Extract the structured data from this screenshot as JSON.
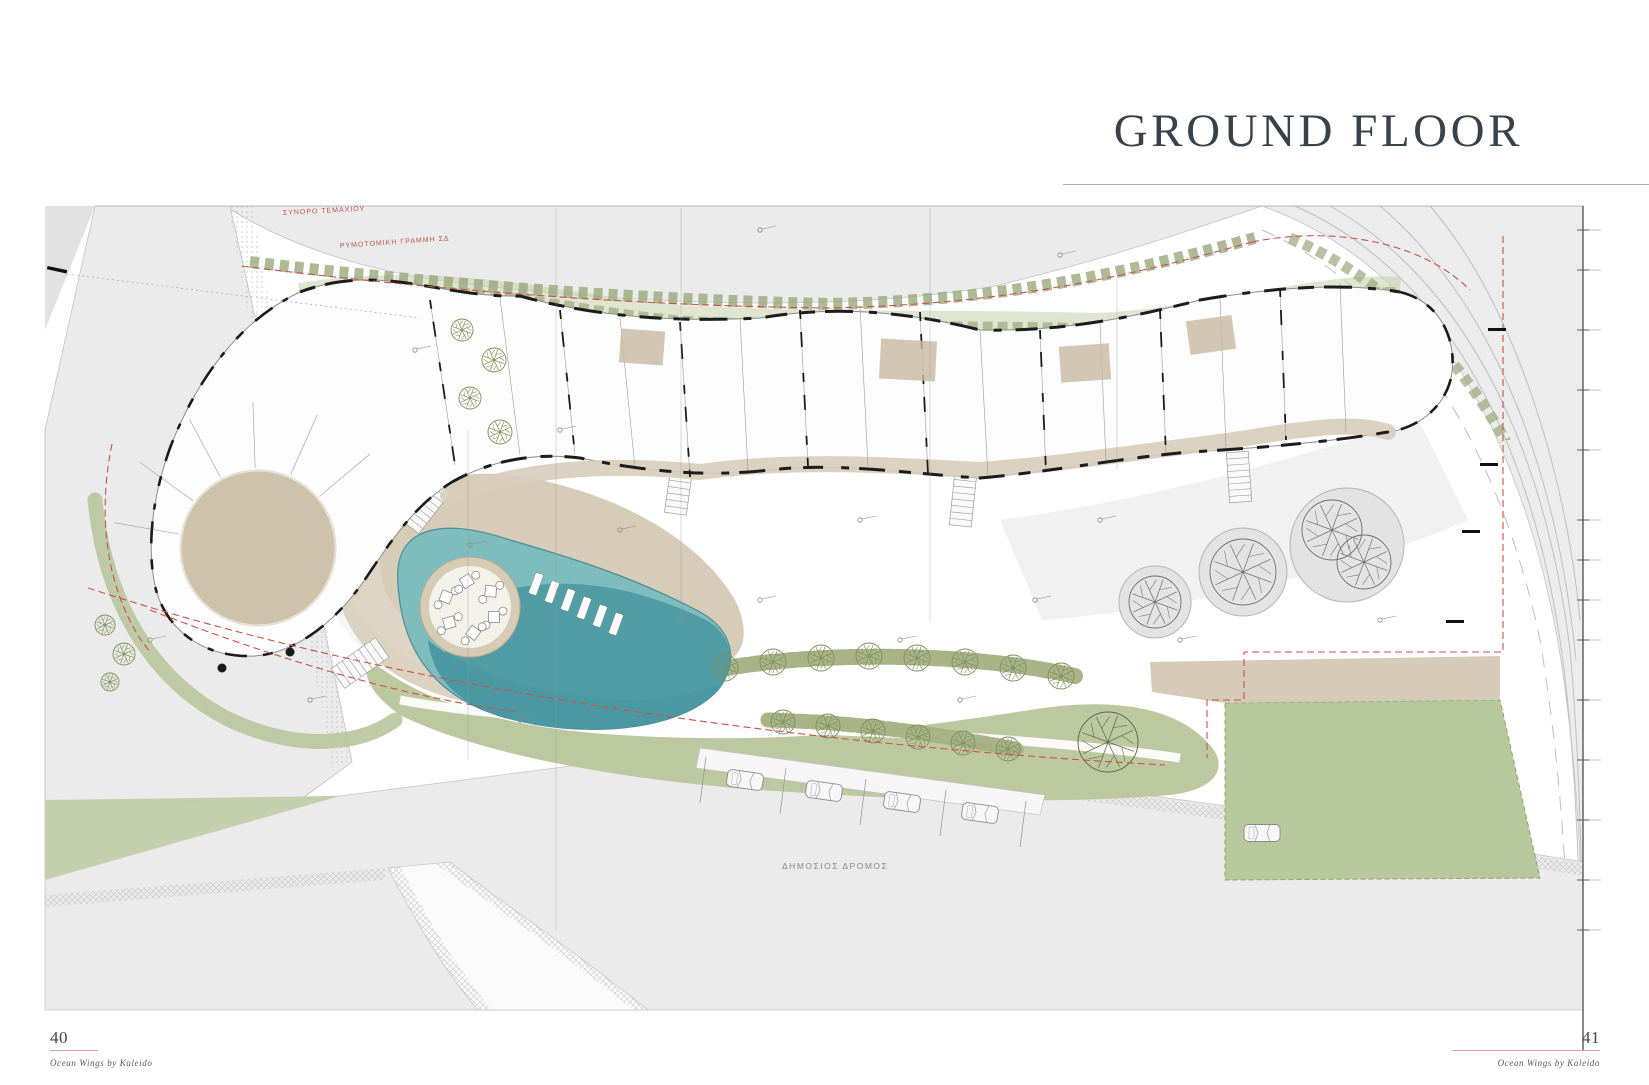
{
  "page": {
    "title": "GROUND FLOOR",
    "left_page_number": "40",
    "right_page_number": "41",
    "left_footer_brand": "Ocean Wings by Kaleido",
    "right_footer_brand": "Ocean Wings by Kaleido"
  },
  "plan": {
    "labels": {
      "plot_boundary": "ΣΥΝΟΡΟ ΤΕΜΑΧΙΟΥ",
      "building_line": "ΡΥΜΟΤΟΜΙΚΗ ΓΡΑΜΜΗ ΣΔ",
      "public_road": "ΔΗΜΟΣΙΟΣ ΔΡΟΜΟΣ"
    },
    "colors": {
      "pool_deep": "#4a98a1",
      "pool_shallow": "#7ebcbd",
      "deck_tan": "#d5c9b4",
      "landscape_green": "#bcc9a0",
      "hedge_olive": "#a3af82",
      "road_grey": "#ebebeb",
      "boundary_red": "#c9524a",
      "accent_underline": "#d8a29c",
      "title_color": "#39424b"
    }
  }
}
